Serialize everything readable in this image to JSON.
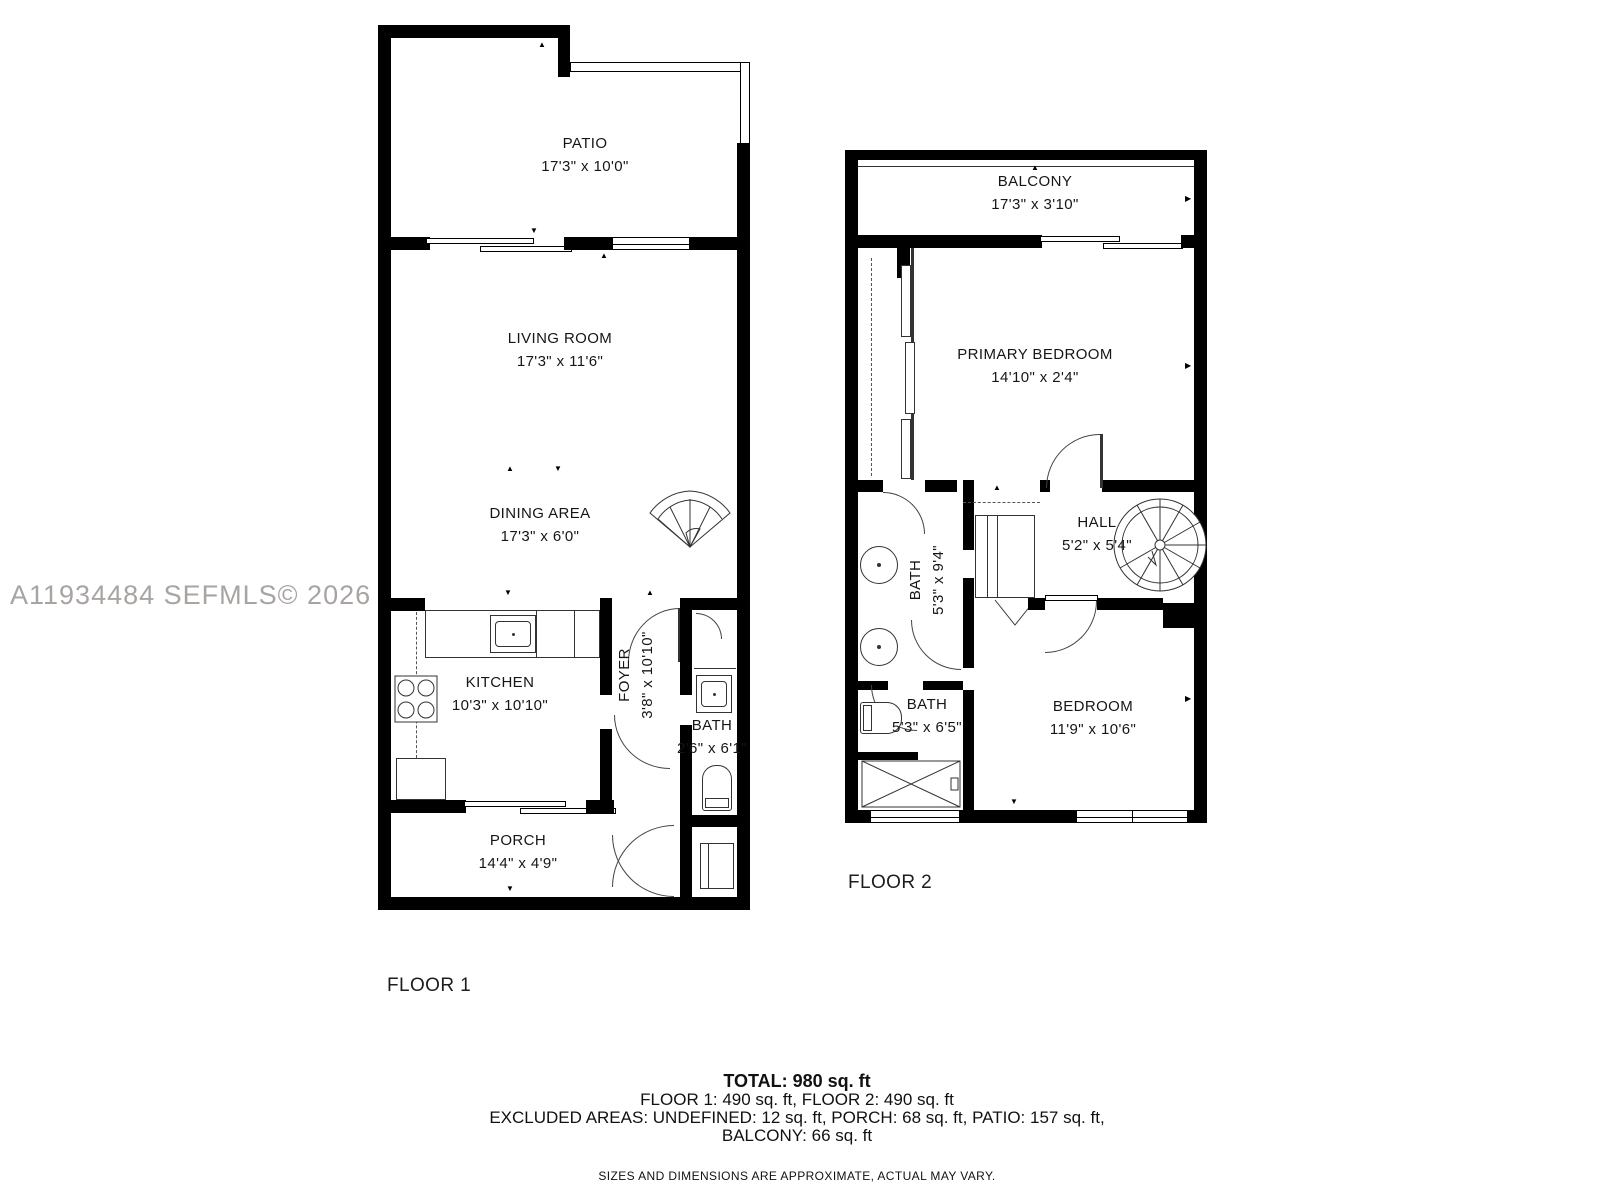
{
  "watermark": "A11934484  SEFMLS© 2026",
  "icons": {
    "tick_up": "▲",
    "tick_down": "▼",
    "tick_left": "◀",
    "tick_right": "▶"
  },
  "floor1": {
    "label": "FLOOR 1",
    "rooms": {
      "patio": {
        "name": "PATIO",
        "dims": "17'3\" x 10'0\""
      },
      "living": {
        "name": "LIVING ROOM",
        "dims": "17'3\" x 11'6\""
      },
      "dining": {
        "name": "DINING AREA",
        "dims": "17'3\" x 6'0\""
      },
      "kitchen": {
        "name": "KITCHEN",
        "dims": "10'3\" x 10'10\""
      },
      "foyer": {
        "name": "FOYER",
        "dims": "3'8\" x 10'10\""
      },
      "bath": {
        "name": "BATH",
        "dims": "2'6\" x 6'1\""
      },
      "porch": {
        "name": "PORCH",
        "dims": "14'4\" x 4'9\""
      }
    }
  },
  "floor2": {
    "label": "FLOOR 2",
    "rooms": {
      "balcony": {
        "name": "BALCONY",
        "dims": "17'3\" x 3'10\""
      },
      "primary": {
        "name": "PRIMARY BEDROOM",
        "dims": "14'10\" x 2'4\""
      },
      "hall": {
        "name": "HALL",
        "dims": "5'2\" x 5'4\""
      },
      "bath_upper": {
        "name": "BATH",
        "dims": "5'3\" x 9'4\""
      },
      "bath_lower": {
        "name": "BATH",
        "dims": "5'3\" x 6'5\""
      },
      "bedroom": {
        "name": "BEDROOM",
        "dims": "11'9\" x 10'6\""
      }
    }
  },
  "summary": {
    "total": "TOTAL: 980 sq. ft",
    "floors": "FLOOR 1: 490 sq. ft, FLOOR 2: 490 sq. ft",
    "excluded": "EXCLUDED AREAS: UNDEFINED: 12 sq. ft, PORCH: 68 sq. ft, PATIO: 157 sq. ft, BALCONY: 66 sq. ft",
    "disclaimer": "SIZES AND DIMENSIONS ARE APPROXIMATE, ACTUAL MAY VARY."
  }
}
